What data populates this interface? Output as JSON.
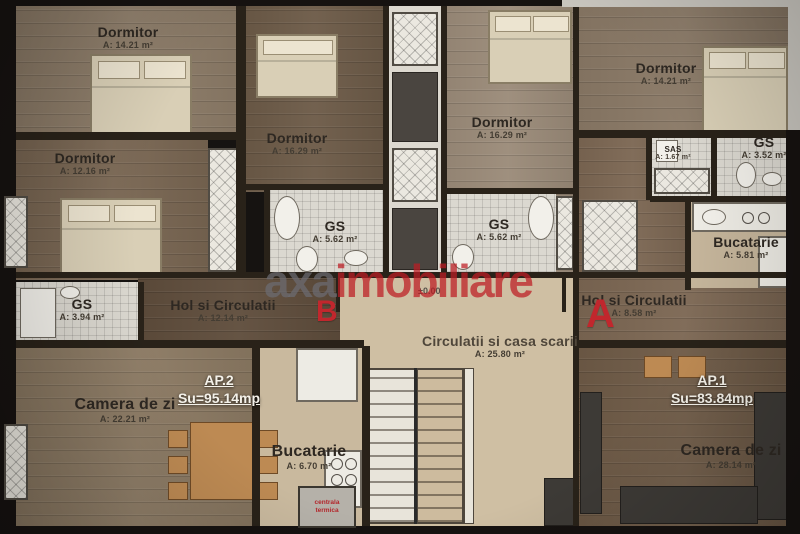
{
  "watermark": {
    "part1": "axa",
    "part2": "imobiliare"
  },
  "level_marker": "±0.00",
  "section_markers": {
    "b": "B",
    "a": "A"
  },
  "boiler_label": "centrala termica",
  "apartments": [
    {
      "id": "AP.1",
      "surface": "Su=83.84mp"
    },
    {
      "id": "AP.2",
      "surface": "Su=95.14mp"
    }
  ],
  "rooms": [
    {
      "name": "Dormitor",
      "area": "A: 14.21 m²"
    },
    {
      "name": "Dormitor",
      "area": "A: 12.16 m²"
    },
    {
      "name": "Dormitor",
      "area": "A: 16.29 m²"
    },
    {
      "name": "Dormitor",
      "area": "A: 16.29 m²"
    },
    {
      "name": "Dormitor",
      "area": "A: 14.21 m²"
    },
    {
      "name": "GS",
      "area": "A: 3.94 m²"
    },
    {
      "name": "GS",
      "area": "A: 5.62 m²"
    },
    {
      "name": "GS",
      "area": "A: 5.62 m²"
    },
    {
      "name": "SAS",
      "area": "A: 1.67 m²"
    },
    {
      "name": "GS",
      "area": "A: 3.52 m²"
    },
    {
      "name": "Bucatarie",
      "area": "A: 5.81 m²"
    },
    {
      "name": "Hol si Circulatii",
      "area": "A: 12.14 m²"
    },
    {
      "name": "Hol si Circulatii",
      "area": "A: 8.58 m²"
    },
    {
      "name": "Camera de zi",
      "area": "A: 22.21 m²"
    },
    {
      "name": "Bucatarie",
      "area": "A: 6.70 m²"
    },
    {
      "name": "Circulatii si casa scarii",
      "area": "A: 25.80 m²"
    },
    {
      "name": "Camera de zi",
      "area": "A: 28.14 m²"
    }
  ],
  "colors": {
    "accent_red": "#c1272d",
    "wall": "#292219",
    "ap_text": "#f4f1e9"
  }
}
